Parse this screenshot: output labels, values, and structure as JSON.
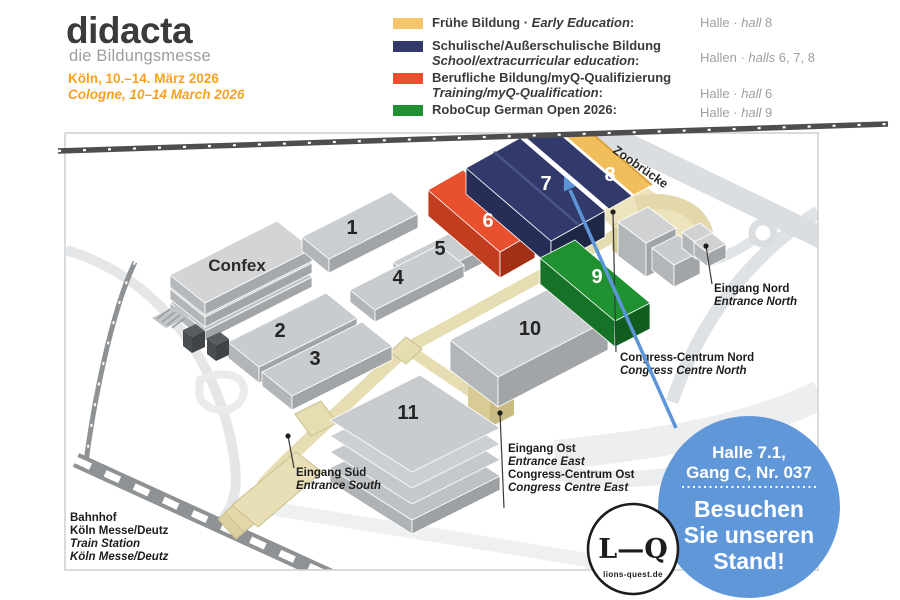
{
  "header": {
    "logo": {
      "title": "didacta",
      "subtitle": "die Bildungsmesse"
    },
    "dates": {
      "de": "Köln, 10.–14. März 2026",
      "en": "Cologne, 10–14 March 2026"
    }
  },
  "legend": {
    "items": [
      {
        "l1": "Frühe Bildung · ",
        "l1i": "Early Education",
        "l1e": ":",
        "l2": "",
        "l2i": "",
        "l2e": "",
        "swatch_color": "#F6C469",
        "hall": {
          "pre": "Halle · ",
          "italic": "hall",
          "post": " 8"
        }
      },
      {
        "l1": "Schulische/Außerschulische Bildung",
        "l1i": "",
        "l1e": "",
        "l2": "",
        "l2i": "School/extracurricular education",
        "l2e": ":",
        "swatch_color": "#32396B",
        "hall": {
          "pre": "Hallen · ",
          "italic": "halls",
          "post": " 6, 7, 8"
        }
      },
      {
        "l1": "Berufliche Bildung/myQ-Qualifizierung",
        "l1i": "",
        "l1e": "",
        "l2": "",
        "l2i": "Training/myQ-Qualification",
        "l2e": ":",
        "swatch_color": "#E8502E",
        "hall": {
          "pre": "Halle · ",
          "italic": "hall",
          "post": " 6"
        }
      },
      {
        "l1": "RoboCup German Open 2026:",
        "l1i": "",
        "l1e": "",
        "l2": "",
        "l2i": "",
        "l2e": "",
        "swatch_color": "#1F9130",
        "hall": {
          "pre": "Halle · ",
          "italic": "hall",
          "post": " 9"
        }
      }
    ]
  },
  "map": {
    "confex": "Confex",
    "zoobruecke": "Zoobrücke",
    "halls": {
      "h1": "1",
      "h2": "2",
      "h3": "3",
      "h4": "4",
      "h5": "5",
      "h6": "6",
      "h7": "7",
      "h8": "8",
      "h9": "9",
      "h10": "10",
      "h11": "11"
    },
    "labels": {
      "eingang_nord": {
        "de": "Eingang Nord",
        "en": "Entrance North"
      },
      "congress_nord": {
        "de": "Congress-Centrum Nord",
        "en": "Congress Centre North"
      },
      "eingang_ost": {
        "de": "Eingang Ost",
        "en": "Entrance East",
        "de2": "Congress-Centrum Ost",
        "en2": "Congress Centre East"
      },
      "eingang_sued": {
        "de": "Eingang Süd",
        "en": "Entrance South"
      },
      "bahnhof": {
        "l1": "Bahnhof",
        "l2": "Köln Messe/Deutz",
        "l3": "Train Station",
        "l4": "Köln Messe/Deutz"
      }
    }
  },
  "badge": {
    "line1": "Halle 7.1,",
    "line2": "Gang C, Nr. 037",
    "cta1": "Besuchen",
    "cta2": "Sie unseren",
    "cta3": "Stand!"
  },
  "logo_lq": {
    "mark": "L—Q",
    "domain": "lions-quest.de"
  },
  "colors": {
    "accent_orange": "#F7A11F",
    "hall6_red": "#E8502E",
    "hall78_navy": "#32396B",
    "hall8_yellow": "#F2BE5C",
    "hall9_green": "#1F9130",
    "badge_blue": "#5F97D9",
    "arrow_blue": "#5C95D8",
    "legend_gray": "#9BA0A4"
  }
}
